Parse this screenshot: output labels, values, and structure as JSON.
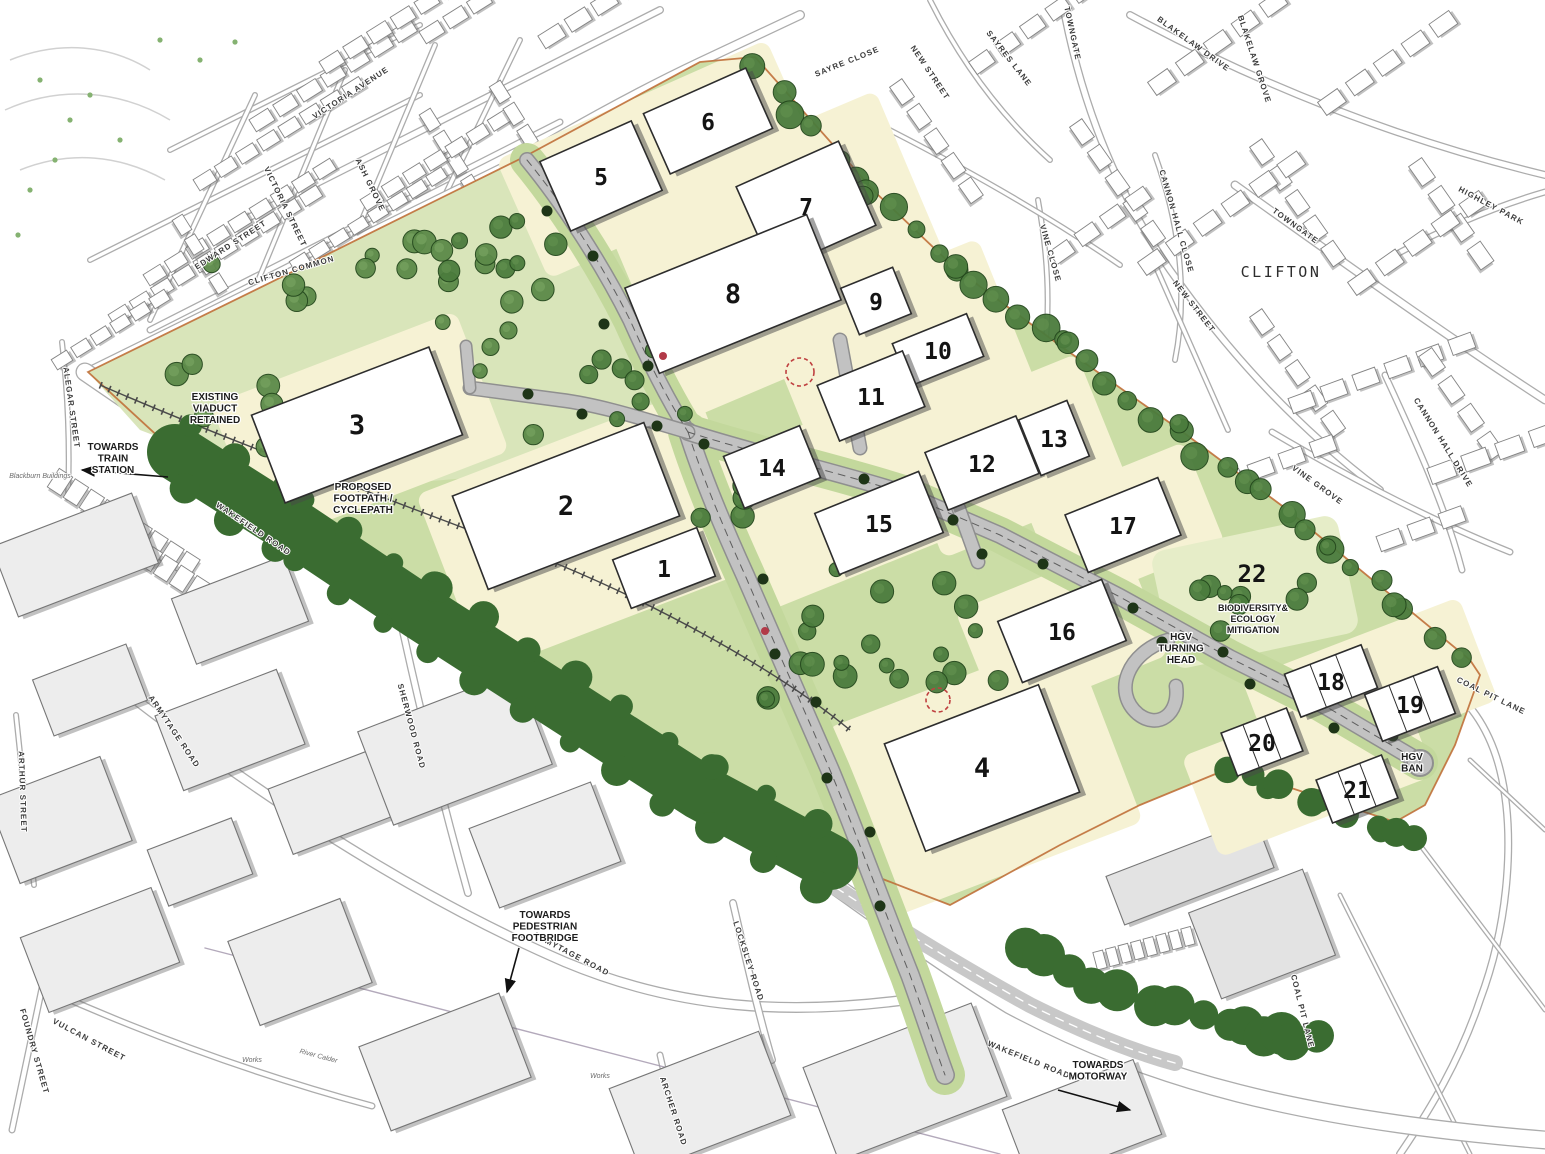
{
  "colors": {
    "site_plot": "#f6f2d4",
    "landscape": "#cbdda6",
    "landscape_light": "#d9e5ba",
    "biodiversity_area": "#e6edc8",
    "tree_belt_dark": "#3a6c31",
    "tree_mid": "#4b7c3d",
    "road_fill": "#c2c2c2",
    "road_casing": "#8f8f8f",
    "context_building": "#ffffff",
    "site_boundary": "#c0703a",
    "red_marker": "#b23a48"
  },
  "plots": [
    {
      "num": "1",
      "x": 664,
      "y": 568,
      "w": 90,
      "h": 52,
      "rot": -21
    },
    {
      "num": "2",
      "x": 566,
      "y": 506,
      "w": 205,
      "h": 100,
      "rot": -21
    },
    {
      "num": "3",
      "x": 357,
      "y": 425,
      "w": 190,
      "h": 94,
      "rot": -21
    },
    {
      "num": "4",
      "x": 982,
      "y": 768,
      "w": 165,
      "h": 115,
      "rot": -21
    },
    {
      "num": "5",
      "x": 601,
      "y": 176,
      "w": 100,
      "h": 76,
      "rot": -24
    },
    {
      "num": "6",
      "x": 708,
      "y": 121,
      "w": 112,
      "h": 66,
      "rot": -24
    },
    {
      "num": "7",
      "x": 806,
      "y": 206,
      "w": 112,
      "h": 92,
      "rot": -24
    },
    {
      "num": "8",
      "x": 733,
      "y": 294,
      "w": 196,
      "h": 92,
      "rot": -22
    },
    {
      "num": "9",
      "x": 876,
      "y": 301,
      "w": 56,
      "h": 50,
      "rot": -22
    },
    {
      "num": "10",
      "x": 938,
      "y": 350,
      "w": 80,
      "h": 46,
      "rot": -22
    },
    {
      "num": "11",
      "x": 871,
      "y": 396,
      "w": 92,
      "h": 60,
      "rot": -22
    },
    {
      "num": "12",
      "x": 982,
      "y": 463,
      "w": 98,
      "h": 62,
      "rot": -22
    },
    {
      "num": "13",
      "x": 1054,
      "y": 438,
      "w": 52,
      "h": 60,
      "rot": -22
    },
    {
      "num": "14",
      "x": 772,
      "y": 467,
      "w": 82,
      "h": 56,
      "rot": -22
    },
    {
      "num": "15",
      "x": 879,
      "y": 523,
      "w": 112,
      "h": 66,
      "rot": -22
    },
    {
      "num": "16",
      "x": 1062,
      "y": 631,
      "w": 112,
      "h": 66,
      "rot": -22
    },
    {
      "num": "17",
      "x": 1123,
      "y": 525,
      "w": 100,
      "h": 62,
      "rot": -22
    },
    {
      "num": "18",
      "x": 1331,
      "y": 681,
      "w": 82,
      "h": 46,
      "rot": -21,
      "units": 3
    },
    {
      "num": "19",
      "x": 1410,
      "y": 704,
      "w": 78,
      "h": 50,
      "rot": -21,
      "units": 3
    },
    {
      "num": "20",
      "x": 1262,
      "y": 742,
      "w": 70,
      "h": 46,
      "rot": -21,
      "units": 3
    },
    {
      "num": "21",
      "x": 1357,
      "y": 789,
      "w": 70,
      "h": 46,
      "rot": -21,
      "units": 3
    }
  ],
  "biodiversity": {
    "num": "22",
    "num_x": 1252,
    "num_y": 582,
    "lines": [
      "BIODIVERSITY&",
      "ECOLOGY",
      "MITIGATION"
    ],
    "text_x": 1253,
    "text_y": 601
  },
  "annotations": [
    {
      "name": "existing-viaduct",
      "lines": [
        "EXISTING",
        "VIADUCT",
        "RETAINED"
      ],
      "x": 215,
      "y": 400,
      "size": 10
    },
    {
      "name": "towards-train-station",
      "lines": [
        "TOWARDS",
        "TRAIN",
        "STATION"
      ],
      "x": 113,
      "y": 450,
      "size": 10
    },
    {
      "name": "proposed-footpath-cyclepath",
      "lines": [
        "PROPOSED",
        "FOOTPATH /",
        "CYCLEPATH"
      ],
      "x": 363,
      "y": 490,
      "size": 10
    },
    {
      "name": "hgv-turning-head",
      "lines": [
        "HGV",
        "TURNING",
        "HEAD"
      ],
      "x": 1181,
      "y": 640,
      "size": 10
    },
    {
      "name": "hgv-ban",
      "lines": [
        "HGV",
        "BAN"
      ],
      "x": 1412,
      "y": 760,
      "size": 10
    },
    {
      "name": "towards-pedestrian-footbridge",
      "lines": [
        "TOWARDS",
        "PEDESTRIAN",
        "FOOTBRIDGE"
      ],
      "x": 545,
      "y": 918,
      "size": 10
    },
    {
      "name": "towards-motorway",
      "lines": [
        "TOWARDS",
        "MOTORWAY"
      ],
      "x": 1098,
      "y": 1068,
      "size": 10
    }
  ],
  "place_labels": [
    {
      "text": "CLIFTON",
      "x": 1281,
      "y": 277,
      "size": 15
    }
  ],
  "street_labels": [
    {
      "text": "VICTORIA AVENUE",
      "x": 352,
      "y": 95,
      "rot": -33
    },
    {
      "text": "VICTORIA STREET",
      "x": 283,
      "y": 208,
      "rot": 64
    },
    {
      "text": "ASH GROVE",
      "x": 368,
      "y": 186,
      "rot": 64
    },
    {
      "text": "EDWARD STREET",
      "x": 232,
      "y": 247,
      "rot": -33
    },
    {
      "text": "CLIFTON COMMON",
      "x": 292,
      "y": 273,
      "rot": -16
    },
    {
      "text": "SAYRE CLOSE",
      "x": 848,
      "y": 64,
      "rot": -22
    },
    {
      "text": "NEW STREET",
      "x": 928,
      "y": 74,
      "rot": 56
    },
    {
      "text": "SAYRES LANE",
      "x": 1007,
      "y": 60,
      "rot": 52
    },
    {
      "text": "TOWNGATE",
      "x": 1070,
      "y": 34,
      "rot": 78
    },
    {
      "text": "BLAKELAW DRIVE",
      "x": 1192,
      "y": 46,
      "rot": 36
    },
    {
      "text": "BLAKELAW GROVE",
      "x": 1252,
      "y": 60,
      "rot": 72
    },
    {
      "text": "HIGHLEY PARK",
      "x": 1490,
      "y": 208,
      "rot": 28
    },
    {
      "text": "TOWNGATE",
      "x": 1294,
      "y": 228,
      "rot": 36
    },
    {
      "text": "CANNON HALL CLOSE",
      "x": 1174,
      "y": 222,
      "rot": 74
    },
    {
      "text": "VINE CLOSE",
      "x": 1048,
      "y": 254,
      "rot": 74
    },
    {
      "text": "NEW STREET",
      "x": 1192,
      "y": 308,
      "rot": 52
    },
    {
      "text": "VINE GROVE",
      "x": 1316,
      "y": 487,
      "rot": 36
    },
    {
      "text": "CANNON HALL DRIVE",
      "x": 1441,
      "y": 444,
      "rot": 58
    },
    {
      "text": "WAKEFIELD ROAD",
      "x": 252,
      "y": 531,
      "rot": 34
    },
    {
      "text": "WAKEFIELD ROAD",
      "x": 1028,
      "y": 1062,
      "rot": 22
    },
    {
      "text": "ARMYTAGE ROAD",
      "x": 172,
      "y": 733,
      "rot": 56
    },
    {
      "text": "ARMYTAGE ROAD",
      "x": 570,
      "y": 956,
      "rot": 28
    },
    {
      "text": "SHERWOOD ROAD",
      "x": 409,
      "y": 727,
      "rot": 75
    },
    {
      "text": "LOCKSLEY ROAD",
      "x": 746,
      "y": 962,
      "rot": 72
    },
    {
      "text": "ARCHER ROAD",
      "x": 671,
      "y": 1112,
      "rot": 72
    },
    {
      "text": "VULCAN STREET",
      "x": 88,
      "y": 1042,
      "rot": 28
    },
    {
      "text": "FOUNDRY STREET",
      "x": 32,
      "y": 1052,
      "rot": 74
    },
    {
      "text": "ALEGAR STREET",
      "x": 69,
      "y": 408,
      "rot": 82
    },
    {
      "text": "ARTHUR STREET",
      "x": 20,
      "y": 792,
      "rot": 88
    },
    {
      "text": "COAL PIT LANE",
      "x": 1490,
      "y": 698,
      "rot": 26
    },
    {
      "text": "COAL PIT LANE",
      "x": 1300,
      "y": 1012,
      "rot": 76
    }
  ],
  "minor_labels": [
    {
      "text": "River Calder",
      "x": 318,
      "y": 1058,
      "rot": 15
    },
    {
      "text": "Works",
      "x": 252,
      "y": 1062,
      "rot": 0
    },
    {
      "text": "Works",
      "x": 600,
      "y": 1078,
      "rot": 0
    },
    {
      "text": "Blackburn Buildings",
      "x": 40,
      "y": 478,
      "rot": 0
    }
  ]
}
